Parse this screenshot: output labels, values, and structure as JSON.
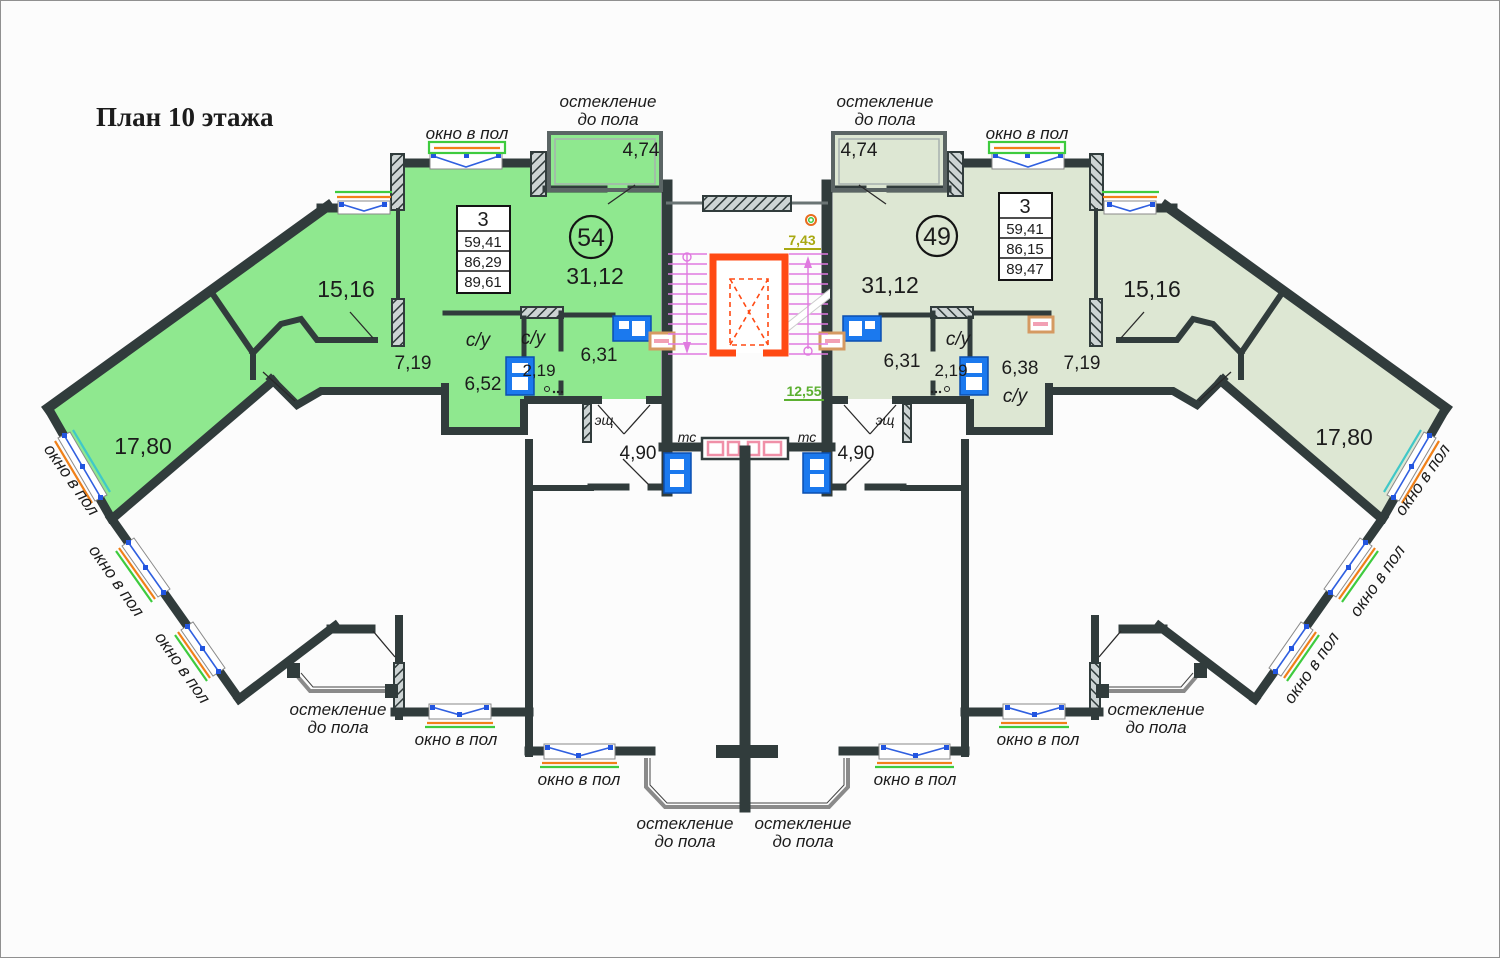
{
  "title": "План 10 этажа",
  "annotations": {
    "window_floor": "окно в пол",
    "glazing_1": "остекление",
    "glazing_2": "до пола"
  },
  "core": {
    "stair_width": "7,43",
    "stair_depth": "12,55",
    "vent_label": "тс",
    "panel_label": "эщ",
    "lobby_area": "4,90"
  },
  "apartment_left": {
    "number": "54",
    "rooms_count": "3",
    "area_living": "59,41",
    "area_total": "86,29",
    "area_overall": "89,61",
    "living_room": "31,12",
    "bedroom_1": "15,16",
    "bedroom_2": "17,80",
    "hall": "7,19",
    "corridor": "6,31",
    "bathroom": "6,52",
    "wc": "2,19",
    "balcony": "4,74",
    "bath_label": "с/у"
  },
  "apartment_right": {
    "number": "49",
    "rooms_count": "3",
    "area_living": "59,41",
    "area_total": "86,15",
    "area_overall": "89,47",
    "living_room": "31,12",
    "bedroom_1": "15,16",
    "bedroom_2": "17,80",
    "hall": "7,19",
    "corridor": "6,31",
    "bathroom": "6,38",
    "wc": "2,19",
    "balcony": "4,74",
    "bath_label": "с/у"
  }
}
